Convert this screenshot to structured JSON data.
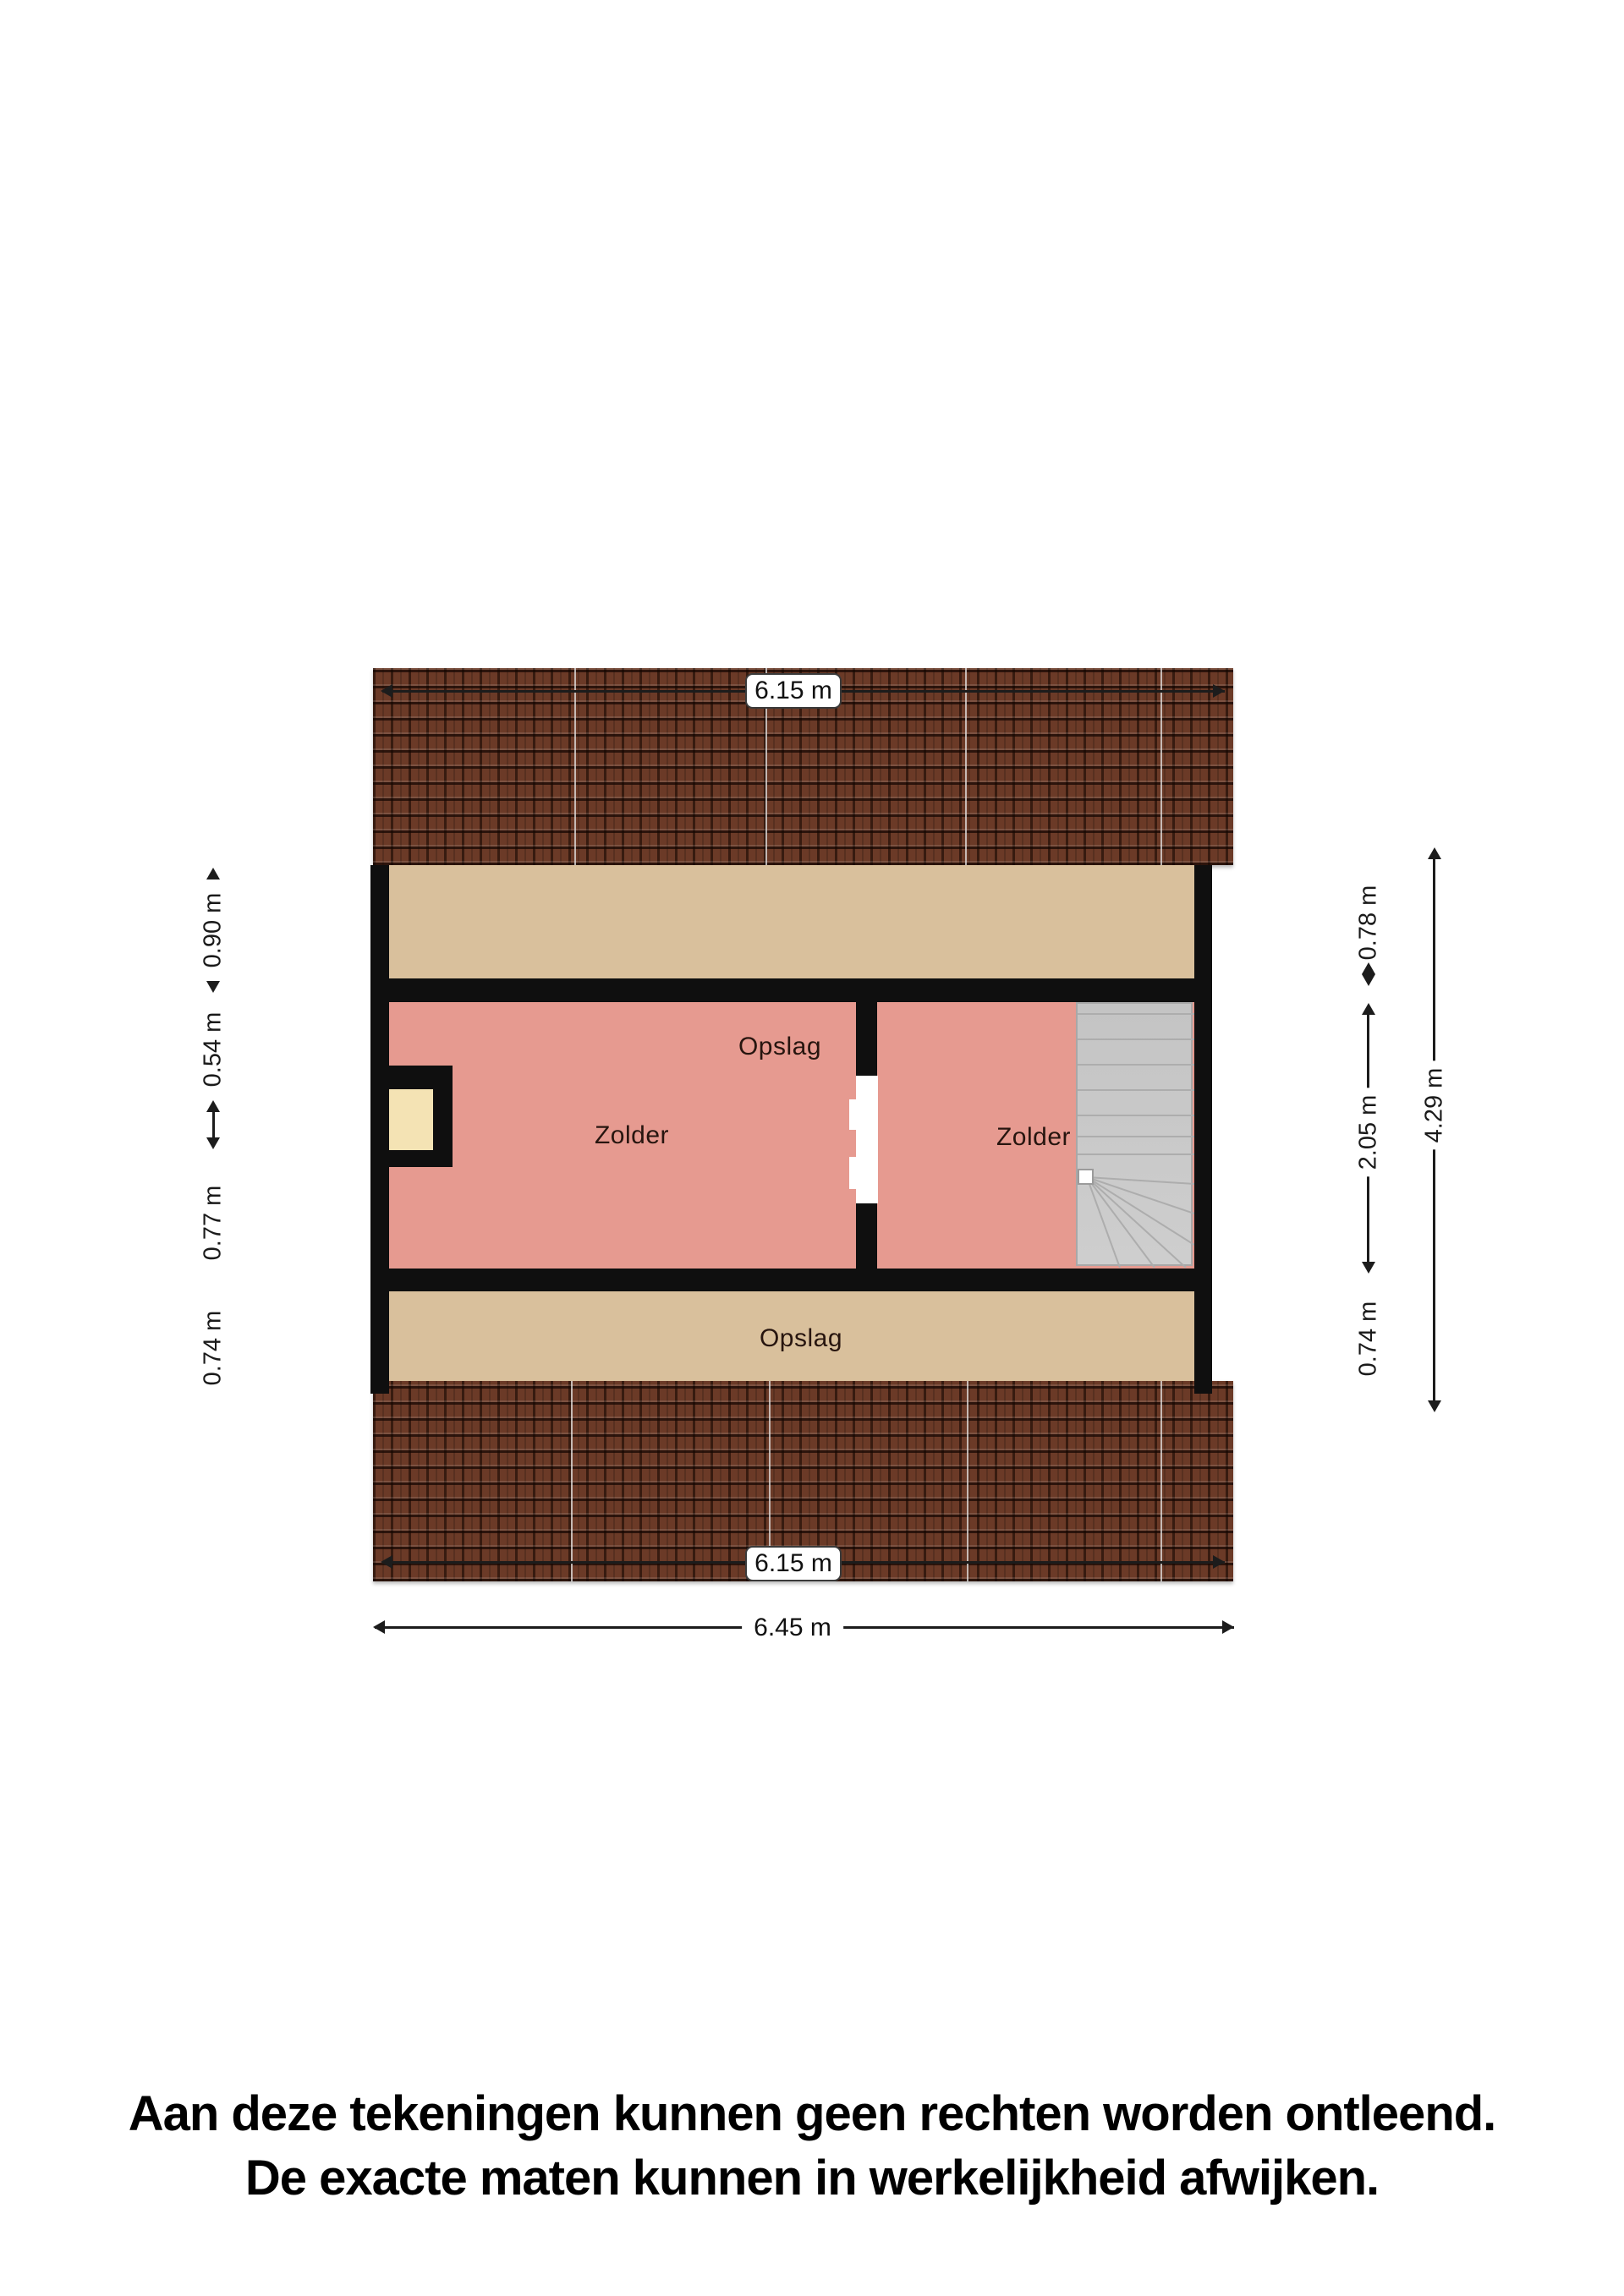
{
  "floorplan": {
    "dim_roof_top": "6.15 m",
    "dim_roof_bottom": "6.15 m",
    "dim_total_width": "6.45 m",
    "dim_total_height": "4.29 m",
    "dims_left": [
      "0.90 m",
      "0.54 m",
      "0.77 m",
      "0.74 m"
    ],
    "dims_right": [
      "0.78 m",
      "2.05 m",
      "0.74 m"
    ],
    "rooms": {
      "opslag_top": "Opslag",
      "zolder_left": "Zolder",
      "zolder_right": "Zolder",
      "opslag_bottom": "Opslag"
    },
    "colors": {
      "wall": "#0f0f0f",
      "room_pink": "#e69a90",
      "storage_beige": "#d9c09c",
      "niche_cream": "#f4e3b4",
      "stairs_gray": "#cbcbcb",
      "roof_brown": "#6b3a27"
    }
  },
  "disclaimer": {
    "line1": "Aan deze tekeningen kunnen geen rechten worden ontleend.",
    "line2": "De exacte maten kunnen in werkelijkheid afwijken."
  }
}
